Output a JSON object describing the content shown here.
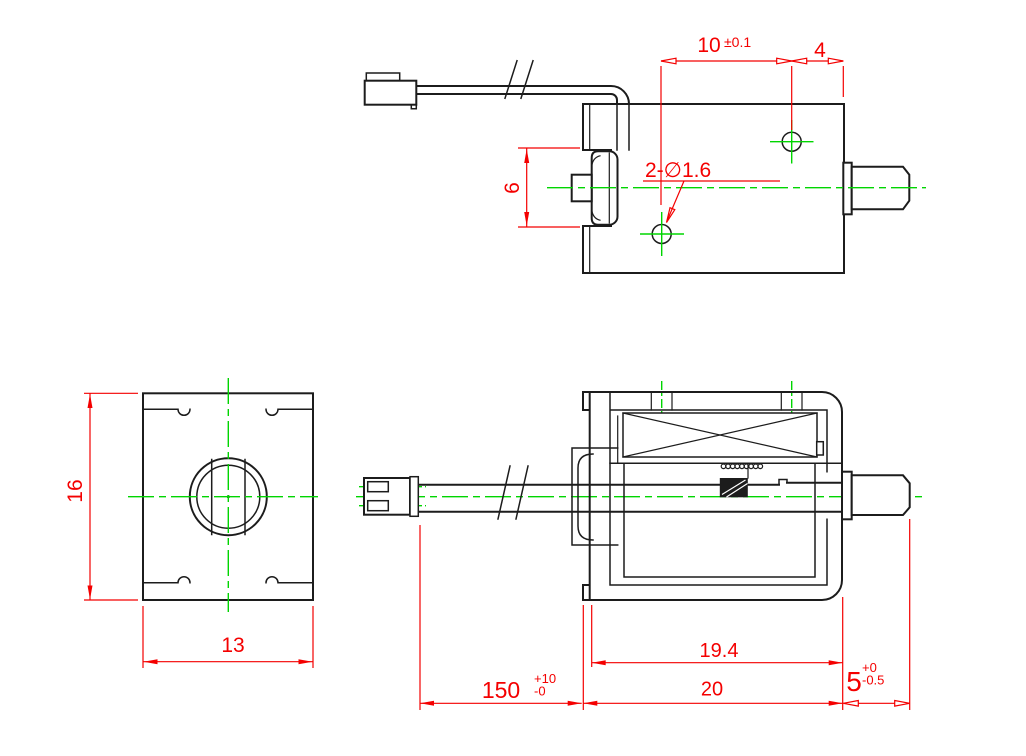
{
  "colors": {
    "outline": "#1c1c1c",
    "dimension": "#f40000",
    "centerline": "#00d500",
    "background": "#ffffff"
  },
  "views": {
    "top": {
      "dim_hole_pitch": "10",
      "dim_hole_pitch_tol": "±0.1",
      "dim_hole_edge": "4",
      "dim_slot_height": "6",
      "label_holes": "2-∅1.6"
    },
    "front": {
      "dim_height": "16",
      "dim_width": "13"
    },
    "side": {
      "dim_inner_length": "19.4",
      "dim_body_length": "20",
      "dim_lead_length": "150",
      "dim_lead_tol_upper": "+10",
      "dim_lead_tol_lower": "-0",
      "dim_tip_length": "5",
      "dim_tip_tol_upper": "+0",
      "dim_tip_tol_lower": "-0.5"
    }
  }
}
